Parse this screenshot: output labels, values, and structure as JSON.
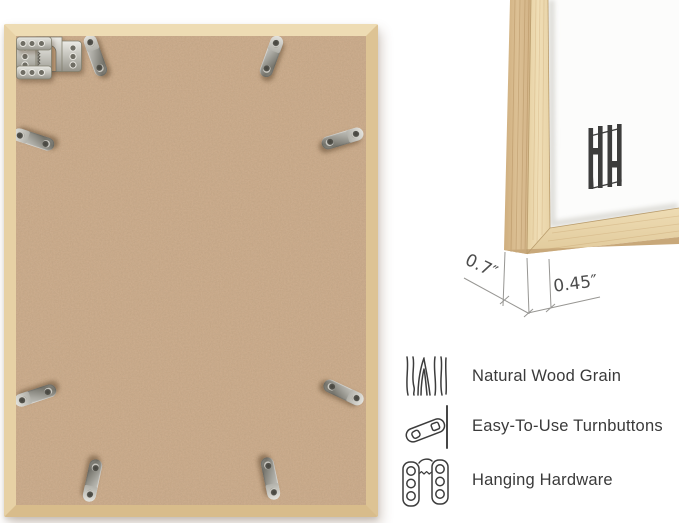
{
  "page": {
    "background": "#ffffff",
    "description": "Picture frame product infographic"
  },
  "frame_back": {
    "wood_color": "#e5cfa2",
    "backing_color": "#c9a786",
    "metal_color": "#c6c5be",
    "turnbutton_count": 8,
    "sawtooth_hanger_count": 2
  },
  "corner_detail": {
    "mat_color": "#fcfcfb",
    "wood_side_color": "#d7b98c",
    "wood_face_color": "#ecd9ae",
    "brand_mark": "HH",
    "dimensions": {
      "depth_label": "0.7″",
      "face_label": "0.45″"
    }
  },
  "features": [
    {
      "icon": "wood-grain-icon",
      "label": "Natural Wood Grain"
    },
    {
      "icon": "turnbutton-icon",
      "label": "Easy-To-Use Turnbuttons"
    },
    {
      "icon": "hanging-hardware-icon",
      "label": "Hanging Hardware"
    }
  ]
}
